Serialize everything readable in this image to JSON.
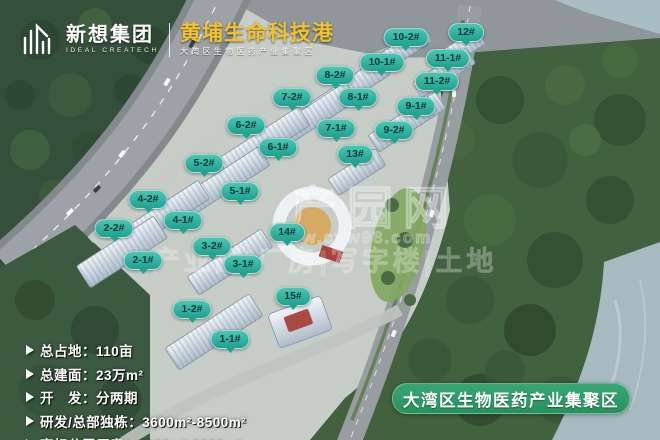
{
  "header": {
    "company_name_cn": "新想集团",
    "company_name_en": "IDEAL CREATECH",
    "project_title": "黄埔生命科技港",
    "project_subtitle": "大湾区生物医药产业集聚区",
    "title_color": "#f2c130"
  },
  "building_labels": [
    {
      "id": "10-2#",
      "x": 406,
      "y": 39
    },
    {
      "id": "12#",
      "x": 466,
      "y": 34
    },
    {
      "id": "10-1#",
      "x": 382,
      "y": 64
    },
    {
      "id": "11-1#",
      "x": 448,
      "y": 60
    },
    {
      "id": "8-2#",
      "x": 335,
      "y": 77
    },
    {
      "id": "11-2#",
      "x": 437,
      "y": 83
    },
    {
      "id": "7-2#",
      "x": 292,
      "y": 99
    },
    {
      "id": "8-1#",
      "x": 358,
      "y": 99
    },
    {
      "id": "9-1#",
      "x": 416,
      "y": 108
    },
    {
      "id": "6-2#",
      "x": 246,
      "y": 127
    },
    {
      "id": "7-1#",
      "x": 336,
      "y": 130
    },
    {
      "id": "9-2#",
      "x": 394,
      "y": 132
    },
    {
      "id": "6-1#",
      "x": 278,
      "y": 149
    },
    {
      "id": "13#",
      "x": 355,
      "y": 156
    },
    {
      "id": "5-2#",
      "x": 204,
      "y": 165
    },
    {
      "id": "5-1#",
      "x": 240,
      "y": 193
    },
    {
      "id": "4-2#",
      "x": 148,
      "y": 201
    },
    {
      "id": "4-1#",
      "x": 183,
      "y": 222
    },
    {
      "id": "2-2#",
      "x": 114,
      "y": 230
    },
    {
      "id": "14#",
      "x": 287,
      "y": 234
    },
    {
      "id": "3-2#",
      "x": 212,
      "y": 248
    },
    {
      "id": "2-1#",
      "x": 143,
      "y": 262
    },
    {
      "id": "3-1#",
      "x": 243,
      "y": 266
    },
    {
      "id": "15#",
      "x": 293,
      "y": 298
    },
    {
      "id": "1-2#",
      "x": 192,
      "y": 311
    },
    {
      "id": "1-1#",
      "x": 230,
      "y": 341
    }
  ],
  "bubble_style": {
    "fill_top": "#4cc6b3",
    "fill_bottom": "#1fa090",
    "text_color": "#0d3c37"
  },
  "info_panel": {
    "items": [
      {
        "text": "总占地：110亩"
      },
      {
        "text": "总建面：23万m²"
      },
      {
        "text": "开　发：分两期"
      },
      {
        "text": "研发/总部独栋：3600m²-8500m²"
      },
      {
        "text": "高标分层厂房：1000m²-3000m²"
      }
    ]
  },
  "badge": {
    "text": "大湾区生物医药产业集聚区",
    "color": "#2f9e6b"
  },
  "watermark": {
    "brand": "产园网",
    "url": "www.cyw98.com",
    "tagline": "产业园|厂房|写字楼|土地"
  }
}
